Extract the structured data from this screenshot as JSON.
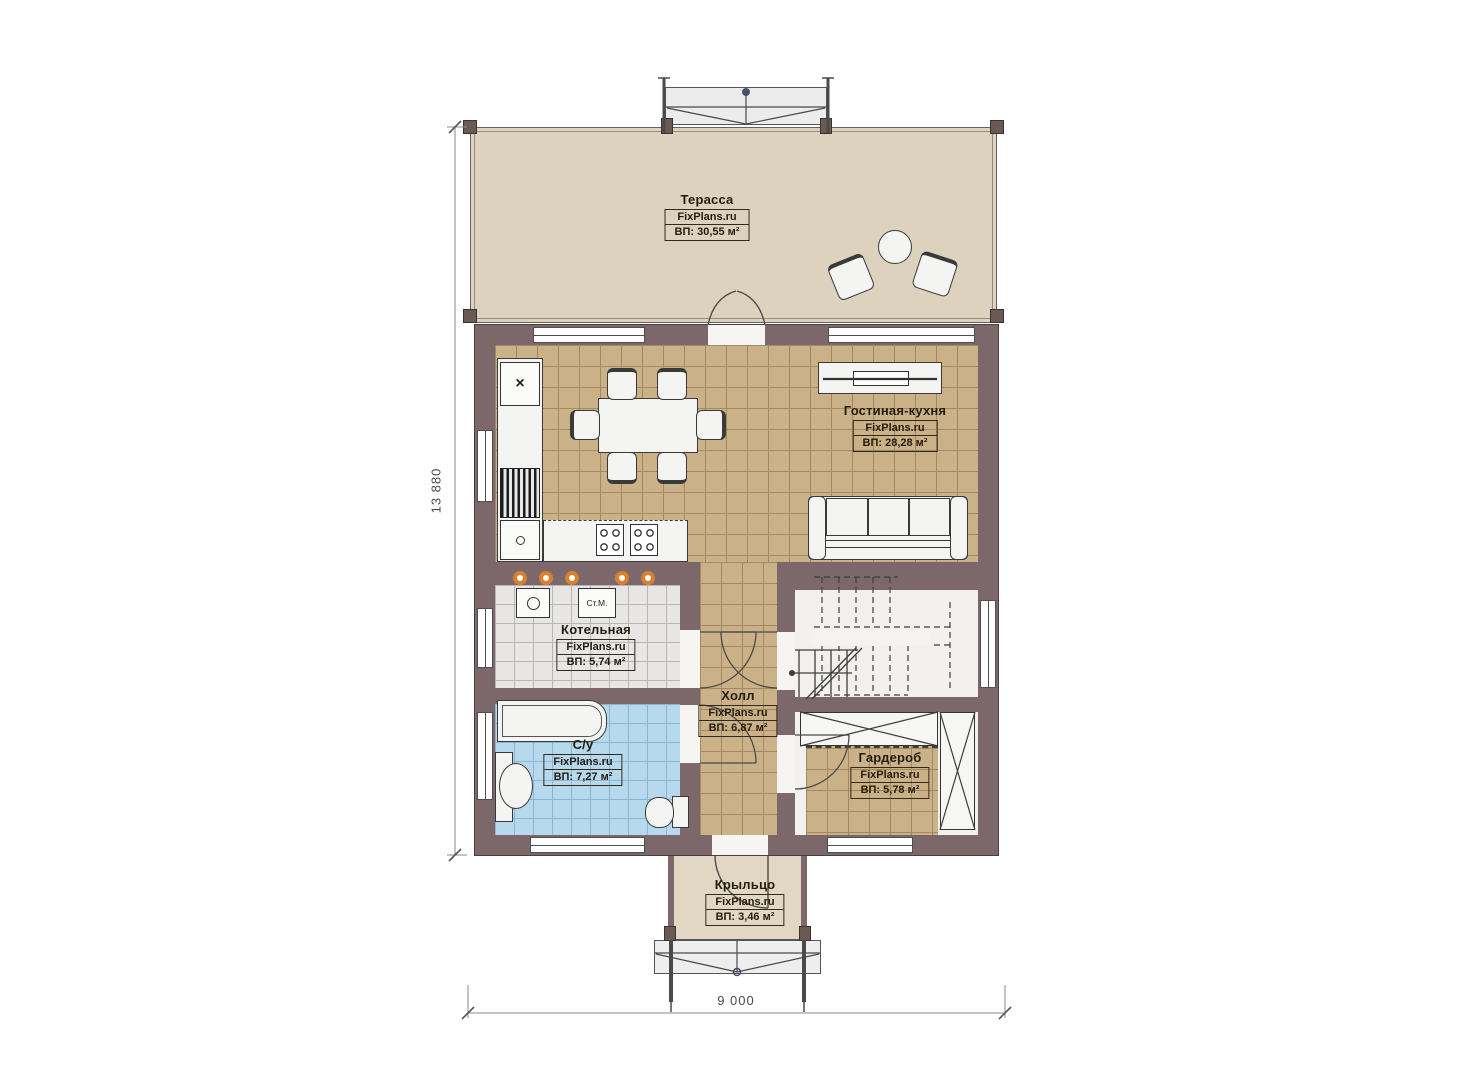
{
  "watermark": "FixPlans.ru",
  "dimensions": {
    "height_label": "13 880",
    "width_label": "9 000"
  },
  "rooms": [
    {
      "id": "terrace",
      "name": "Терасса",
      "brand": "FixPlans.ru",
      "area": "ВП: 30,55 м²"
    },
    {
      "id": "living",
      "name": "Гостиная-кухня",
      "brand": "FixPlans.ru",
      "area": "ВП: 28,28 м²"
    },
    {
      "id": "boiler",
      "name": "Котельная",
      "brand": "FixPlans.ru",
      "area": "ВП: 5,74 м²"
    },
    {
      "id": "bath",
      "name": "С/у",
      "brand": "FixPlans.ru",
      "area": "ВП: 7,27 м²"
    },
    {
      "id": "hall",
      "name": "Холл",
      "brand": "FixPlans.ru",
      "area": "ВП: 6,87 м²"
    },
    {
      "id": "wardrobe",
      "name": "Гардероб",
      "brand": "FixPlans.ru",
      "area": "ВП: 5,78 м²"
    },
    {
      "id": "porch",
      "name": "Крыльцо",
      "brand": "FixPlans.ru",
      "area": "ВП: 3,46 м²"
    }
  ],
  "appliances": {
    "washing_machine": "Ст.М."
  },
  "icons": {
    "sink_drain": "×"
  },
  "colors": {
    "wall": "#7c686a",
    "floor_tile_tan": "#cbb188",
    "floor_tile_gray": "#e7e6e5",
    "floor_tile_blue": "#b7d9ee",
    "terrace_deck": "#ddd2bd",
    "accent_dot_orange": "#d8802f"
  }
}
